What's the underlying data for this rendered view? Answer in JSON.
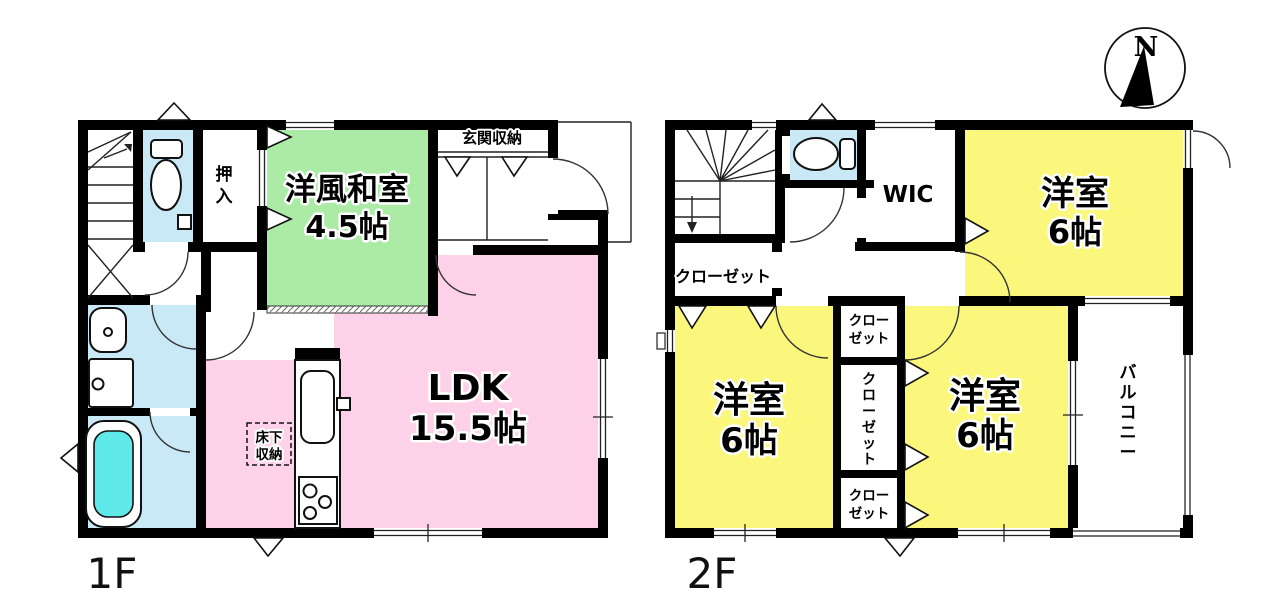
{
  "compass": {
    "north": "N"
  },
  "floor1": {
    "label": "1F",
    "entrance_storage": "玄関収納",
    "oshiire_chars": [
      "押",
      "入"
    ],
    "tatami_room": {
      "name": "洋風和室",
      "size": "4.5帖"
    },
    "ldk": {
      "name": "LDK",
      "size": "15.5帖"
    },
    "underfloor": [
      "床下",
      "収納"
    ]
  },
  "floor2": {
    "label": "2F",
    "wic": "WIC",
    "hall_closet": "クローゼット",
    "bedroom_top": {
      "name": "洋室",
      "size": "6帖"
    },
    "bedroom_left": {
      "name": "洋室",
      "size": "6帖"
    },
    "bedroom_right": {
      "name": "洋室",
      "size": "6帖"
    },
    "closet_small": [
      "クロー",
      "ゼット"
    ],
    "closet_vertical_chars": [
      "ク",
      "ロ",
      "ー",
      "ゼ",
      "ッ",
      "ト"
    ],
    "balcony_chars": [
      "バ",
      "ル",
      "コ",
      "ニ",
      "ー"
    ]
  },
  "colors": {
    "tatami_green": "#abeba6",
    "ldk_pink": "#fdd2e8",
    "bedroom_yellow": "#fbf77d",
    "wet_area_blue": "#c9e9f6",
    "bathtub_cyan": "#5fe9e9",
    "wall_black": "#000000"
  }
}
